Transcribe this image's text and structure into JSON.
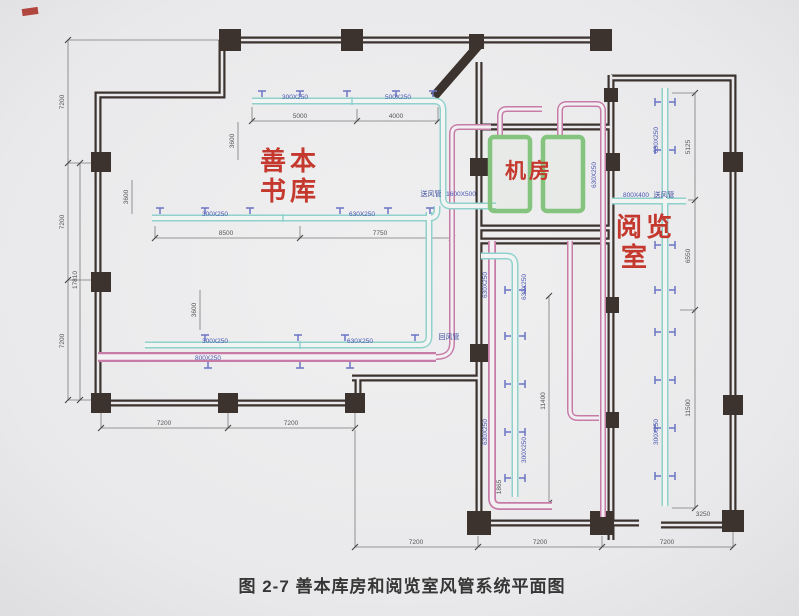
{
  "caption": "图 2-7 善本库房和阅览室风管系统平面图",
  "rooms": {
    "rare_book": {
      "line1": "善本",
      "line2": "书库"
    },
    "machine": "机房",
    "reading": {
      "line1": "阅览",
      "line2": "室"
    }
  },
  "ducts": {
    "top_seg1": "300X250",
    "top_seg2": "500X250",
    "mid_seg1": "300X250",
    "mid_seg2": "630X250",
    "bot_seg1": "300X250",
    "bot_seg2": "630X250",
    "bot_return": "800X250",
    "riser_label": "送风管",
    "riser_size": "1600X500",
    "return_label": "回风管",
    "read_supply_size": "800X400",
    "read_supply_label": "送风管",
    "corr_pink_up": "630X250",
    "corr_cyan_up": "630X250",
    "corr_pink_low": "630X250",
    "corr_cyan_low": "300X250",
    "wall_duct": "630X250",
    "read_up": "630X250",
    "read_low": "300X250"
  },
  "dims": {
    "left1": "7200",
    "left2": "7200",
    "left3": "7200",
    "left_total": "17810",
    "top1": "5000",
    "top2": "4000",
    "mid1": "8500",
    "mid2": "7750",
    "off_a": "3600",
    "off_b": "3600",
    "off_c": "3600",
    "bl1": "7200",
    "bl2": "7200",
    "bm1": "7200",
    "bm2": "7200",
    "bm3": "7200",
    "r1": "5125",
    "r2": "6550",
    "r3": "11500",
    "r_gap": "3250",
    "corr_v": "11400",
    "corr_gap": "1865"
  }
}
